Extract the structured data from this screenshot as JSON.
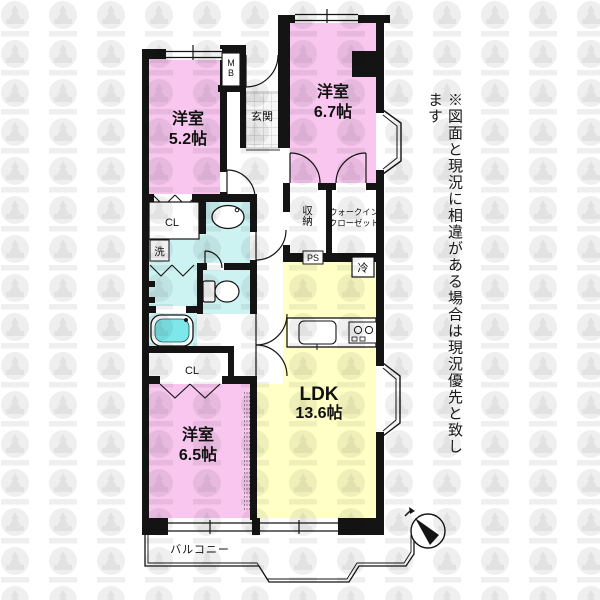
{
  "colors": {
    "wall": "#141414",
    "room_pink": "#f8c6ee",
    "room_yellow": "#ffffc6",
    "wet_cyan": "#ccf2f2",
    "tub_cyan": "#7ee7ea",
    "tile_bg": "#f7f7f7",
    "tile_line": "#c8c8c8",
    "watermark_gray": "#efefef",
    "watermark_dark": "#e2e2e2",
    "text_black": "#111111"
  },
  "plan": {
    "rooms": {
      "bedroom_52": {
        "name": "洋室",
        "size": "5.2帖"
      },
      "bedroom_67": {
        "name": "洋室",
        "size": "6.7帖"
      },
      "bedroom_65": {
        "name": "洋室",
        "size": "6.5帖"
      },
      "ldk": {
        "name": "LDK",
        "size": "13.6帖"
      },
      "entrance": "玄関",
      "storage": "収納",
      "walk_in_closet_line1": "ウォークイン",
      "walk_in_closet_line2": "クローゼット",
      "closet_upper": "CL",
      "closet_lower": "CL",
      "laundry": "洗",
      "balcony": "バルコニー"
    },
    "boxes": {
      "meter_box": "MB",
      "pipe_space": "PS",
      "refrigerator": "冷"
    }
  },
  "notes": {
    "disclaimer": "※図面と現況に相違がある場合は現況優先と致します"
  }
}
